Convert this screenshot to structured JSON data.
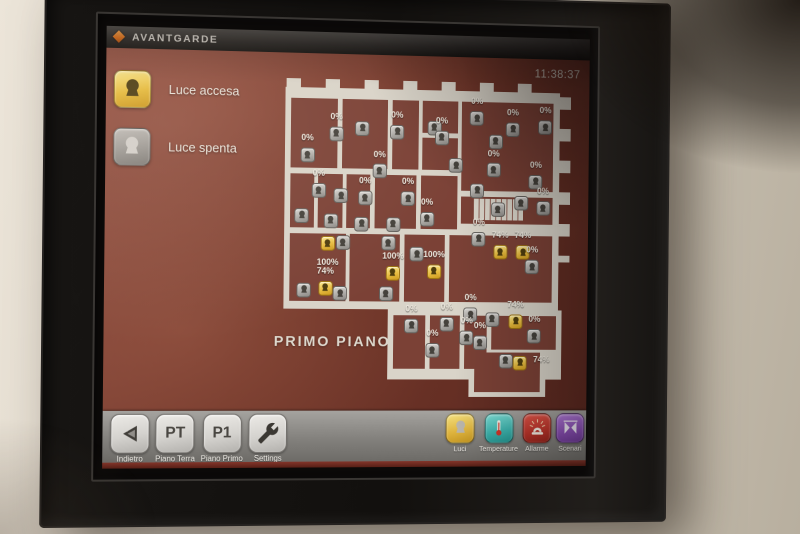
{
  "topbar": {
    "logo_text": "AVANTGARDE",
    "time": "11:38:37"
  },
  "legend": {
    "items": [
      {
        "state": "on",
        "label": "Luce accesa"
      },
      {
        "state": "off",
        "label": "Luce spenta"
      }
    ]
  },
  "plan": {
    "title": "PRIMO PIANO",
    "lamps": [
      {
        "x": 19.0,
        "y": 16.9,
        "state": "off",
        "level": "0%",
        "pos": "a"
      },
      {
        "x": 27.9,
        "y": 15.1,
        "state": "off"
      },
      {
        "x": 9.2,
        "y": 23.7,
        "state": "off",
        "level": "0%",
        "pos": "a"
      },
      {
        "x": 39.7,
        "y": 16.0,
        "state": "off",
        "level": "0%",
        "pos": "a"
      },
      {
        "x": 52.5,
        "y": 14.5,
        "state": "off"
      },
      {
        "x": 33.8,
        "y": 28.3,
        "state": "off",
        "level": "0%",
        "pos": "a"
      },
      {
        "x": 55.1,
        "y": 17.5,
        "state": "off",
        "level": "0%",
        "pos": "a"
      },
      {
        "x": 67.2,
        "y": 11.4,
        "state": "off",
        "level": "0%",
        "pos": "a"
      },
      {
        "x": 60.0,
        "y": 26.2,
        "state": "off"
      },
      {
        "x": 79.7,
        "y": 14.5,
        "state": "off",
        "level": "0%",
        "pos": "a"
      },
      {
        "x": 91.1,
        "y": 13.8,
        "state": "off",
        "level": "0%",
        "pos": "a"
      },
      {
        "x": 73.8,
        "y": 18.5,
        "state": "off"
      },
      {
        "x": 73.1,
        "y": 27.4,
        "state": "off",
        "level": "0%",
        "pos": "a"
      },
      {
        "x": 87.9,
        "y": 30.8,
        "state": "off",
        "level": "0%",
        "pos": "a"
      },
      {
        "x": 67.5,
        "y": 33.8,
        "state": "off"
      },
      {
        "x": 90.5,
        "y": 39.1,
        "state": "off",
        "level": "0%",
        "pos": "a"
      },
      {
        "x": 13.1,
        "y": 34.5,
        "state": "off",
        "level": "0%",
        "pos": "a"
      },
      {
        "x": 20.7,
        "y": 36.0,
        "state": "off"
      },
      {
        "x": 28.9,
        "y": 36.6,
        "state": "off",
        "level": "0%",
        "pos": "a"
      },
      {
        "x": 43.6,
        "y": 36.6,
        "state": "off",
        "level": "0%",
        "pos": "a"
      },
      {
        "x": 7.5,
        "y": 42.2,
        "state": "off"
      },
      {
        "x": 17.4,
        "y": 43.7,
        "state": "off"
      },
      {
        "x": 27.9,
        "y": 44.6,
        "state": "off"
      },
      {
        "x": 38.7,
        "y": 44.6,
        "state": "off"
      },
      {
        "x": 50.2,
        "y": 42.8,
        "state": "off",
        "level": "0%",
        "pos": "a"
      },
      {
        "x": 74.8,
        "y": 39.7,
        "state": "off"
      },
      {
        "x": 82.9,
        "y": 37.5,
        "state": "off"
      },
      {
        "x": 68.2,
        "y": 48.9,
        "state": "off",
        "level": "0%",
        "pos": "a"
      },
      {
        "x": 86.9,
        "y": 57.5,
        "state": "off",
        "level": "0%",
        "pos": "a"
      },
      {
        "x": 21.6,
        "y": 50.5,
        "state": "off"
      },
      {
        "x": 8.5,
        "y": 65.2,
        "state": "off"
      },
      {
        "x": 20.7,
        "y": 66.2,
        "state": "off"
      },
      {
        "x": 37.0,
        "y": 50.5,
        "state": "off"
      },
      {
        "x": 36.4,
        "y": 66.2,
        "state": "off"
      },
      {
        "x": 46.9,
        "y": 53.8,
        "state": "off"
      },
      {
        "x": 45.2,
        "y": 76.0,
        "state": "off",
        "level": "0%",
        "pos": "a"
      },
      {
        "x": 57.4,
        "y": 75.4,
        "state": "off",
        "level": "0%",
        "pos": "a"
      },
      {
        "x": 65.6,
        "y": 72.5,
        "state": "off",
        "level": "0%",
        "pos": "a"
      },
      {
        "x": 64.3,
        "y": 79.7,
        "state": "off",
        "level": "0%",
        "pos": "a"
      },
      {
        "x": 68.9,
        "y": 81.2,
        "state": "off",
        "level": "0%",
        "pos": "a"
      },
      {
        "x": 52.5,
        "y": 83.7,
        "state": "off",
        "level": "0%",
        "pos": "a"
      },
      {
        "x": 73.1,
        "y": 73.8,
        "state": "off"
      },
      {
        "x": 87.9,
        "y": 79.1,
        "state": "off",
        "level": "0%",
        "pos": "a"
      },
      {
        "x": 78.0,
        "y": 86.8,
        "state": "off"
      },
      {
        "x": 16.4,
        "y": 50.8,
        "state": "on",
        "level": "100%",
        "pos": "b"
      },
      {
        "x": 15.7,
        "y": 64.6,
        "state": "on",
        "level": "74%",
        "pos": "a"
      },
      {
        "x": 38.7,
        "y": 59.7,
        "state": "on",
        "level": "100%",
        "pos": "a"
      },
      {
        "x": 52.8,
        "y": 59.1,
        "state": "on",
        "level": "100%",
        "pos": "a"
      },
      {
        "x": 75.7,
        "y": 52.9,
        "state": "on",
        "level": "74%",
        "pos": "a"
      },
      {
        "x": 83.6,
        "y": 52.9,
        "state": "on",
        "level": "74%",
        "pos": "a"
      },
      {
        "x": 81.3,
        "y": 74.5,
        "state": "on",
        "level": "74%",
        "pos": "a"
      },
      {
        "x": 83.0,
        "y": 87.4,
        "state": "on",
        "level": "74%",
        "pos": "r"
      }
    ]
  },
  "toolbar_left": {
    "items": [
      {
        "icon": "back-icon",
        "label": "Indietro"
      },
      {
        "text": "PT",
        "label": "Piano Terra"
      },
      {
        "text": "P1",
        "label": "Piano Primo"
      },
      {
        "icon": "wrench-icon",
        "label": "Settings"
      }
    ]
  },
  "toolbar_right": {
    "items": [
      {
        "icon": "bulb-icon",
        "label": "Luci",
        "color": "#e7c84e"
      },
      {
        "icon": "thermometer-icon",
        "label": "Temperature",
        "color": "#3cb5af"
      },
      {
        "icon": "alarm-icon",
        "label": "Allarme",
        "color": "#c23b30"
      },
      {
        "icon": "curtain-icon",
        "label": "Scenari",
        "color": "#9055b8"
      }
    ]
  },
  "colors": {
    "accent_orange": "#e0731d",
    "screen_maroon": "#703529",
    "plan_surface": "#d9d4c9",
    "room_fill": "#7b4136",
    "lamp_on": "#e9c53f",
    "lamp_off": "#b3b1ad",
    "toolbar_gray": "#8d8b87"
  }
}
